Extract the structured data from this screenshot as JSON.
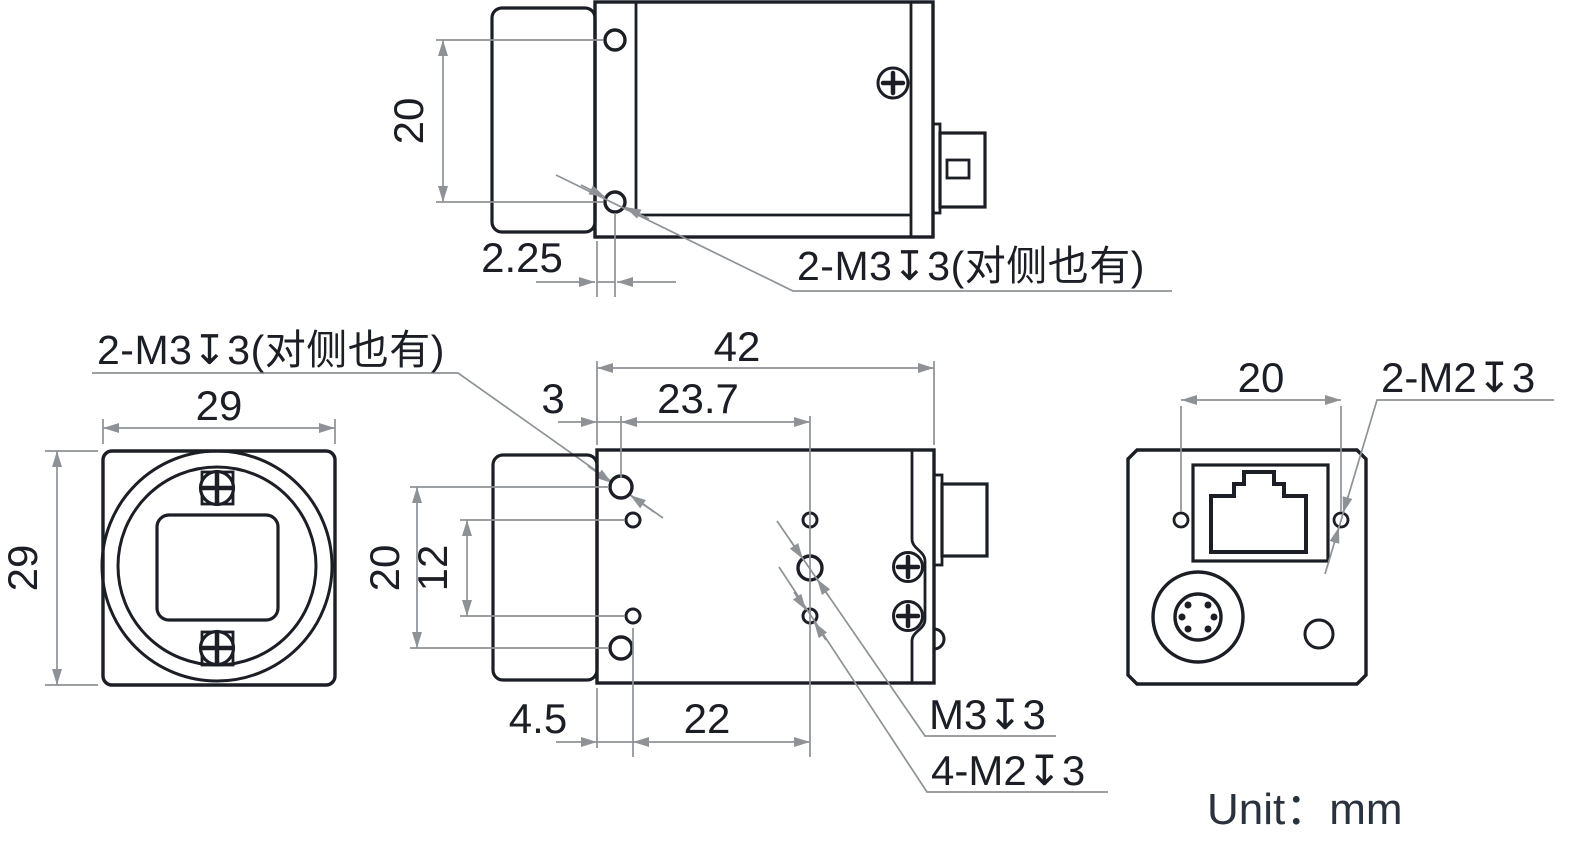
{
  "drawing": {
    "title": "camera-dimension-drawing",
    "unit_note": "Unit：mm",
    "colors": {
      "line": "#1b1e24",
      "dimension": "#8e9296",
      "background": "#ffffff"
    },
    "views": {
      "top": {
        "name": "top view",
        "dims": {
          "hole_spacing": "20",
          "edge_to_hole": "2.25"
        },
        "thread_label": "2-M3↧3(对侧也有)"
      },
      "front": {
        "name": "front view",
        "dims": {
          "width": "29",
          "height": "29"
        },
        "thread_label": "2-M3↧3(对侧也有)"
      },
      "side": {
        "name": "side view",
        "dims": {
          "length": "42",
          "front_to_m3": "3",
          "m3_to_center": "23.7",
          "m3_vertical": "20",
          "m2_vertical": "12",
          "bottom_front": "4.5",
          "bottom_span": "22"
        },
        "m3_label": "M3↧3",
        "m2_label": "4-M2↧3"
      },
      "back": {
        "name": "back view",
        "dims": {
          "hole_spacing": "20"
        },
        "thread_label": "2-M2↧3"
      }
    }
  }
}
